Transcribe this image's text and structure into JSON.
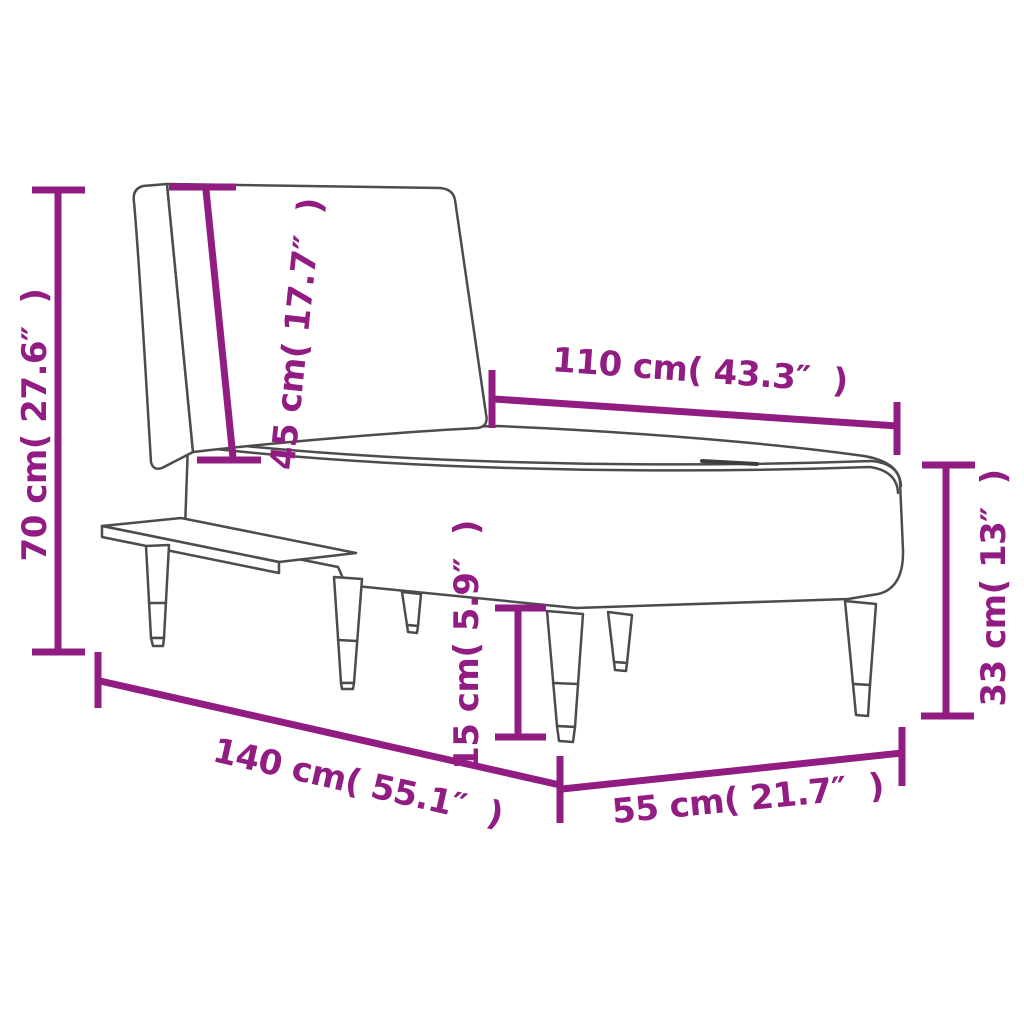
{
  "figure": {
    "background": "#ffffff",
    "artwork_line_color": "#4c4c4c",
    "dimension_color": "#911c82",
    "subject": "chaise-lounge-line-drawing"
  },
  "dimensions": {
    "back_height": {
      "cm": "70",
      "inch": "27.6",
      "label": "70 cm( 27.6″  )"
    },
    "backrest_length": {
      "cm": "45",
      "inch": "17.7",
      "label": "45 cm( 17.7″  )"
    },
    "seat_length": {
      "cm": "110",
      "inch": "43.3",
      "label": "110 cm( 43.3″  )"
    },
    "side_height": {
      "cm": "33",
      "inch": "13",
      "label": "33 cm( 13″  )"
    },
    "leg_height": {
      "cm": "15",
      "inch": "5.9",
      "label": "15 cm( 5.9″  )"
    },
    "total_length": {
      "cm": "140",
      "inch": "55.1",
      "label": "140 cm( 55.1″  )"
    },
    "seat_width": {
      "cm": "55",
      "inch": "21.7",
      "label": "55 cm( 21.7″  )"
    }
  }
}
